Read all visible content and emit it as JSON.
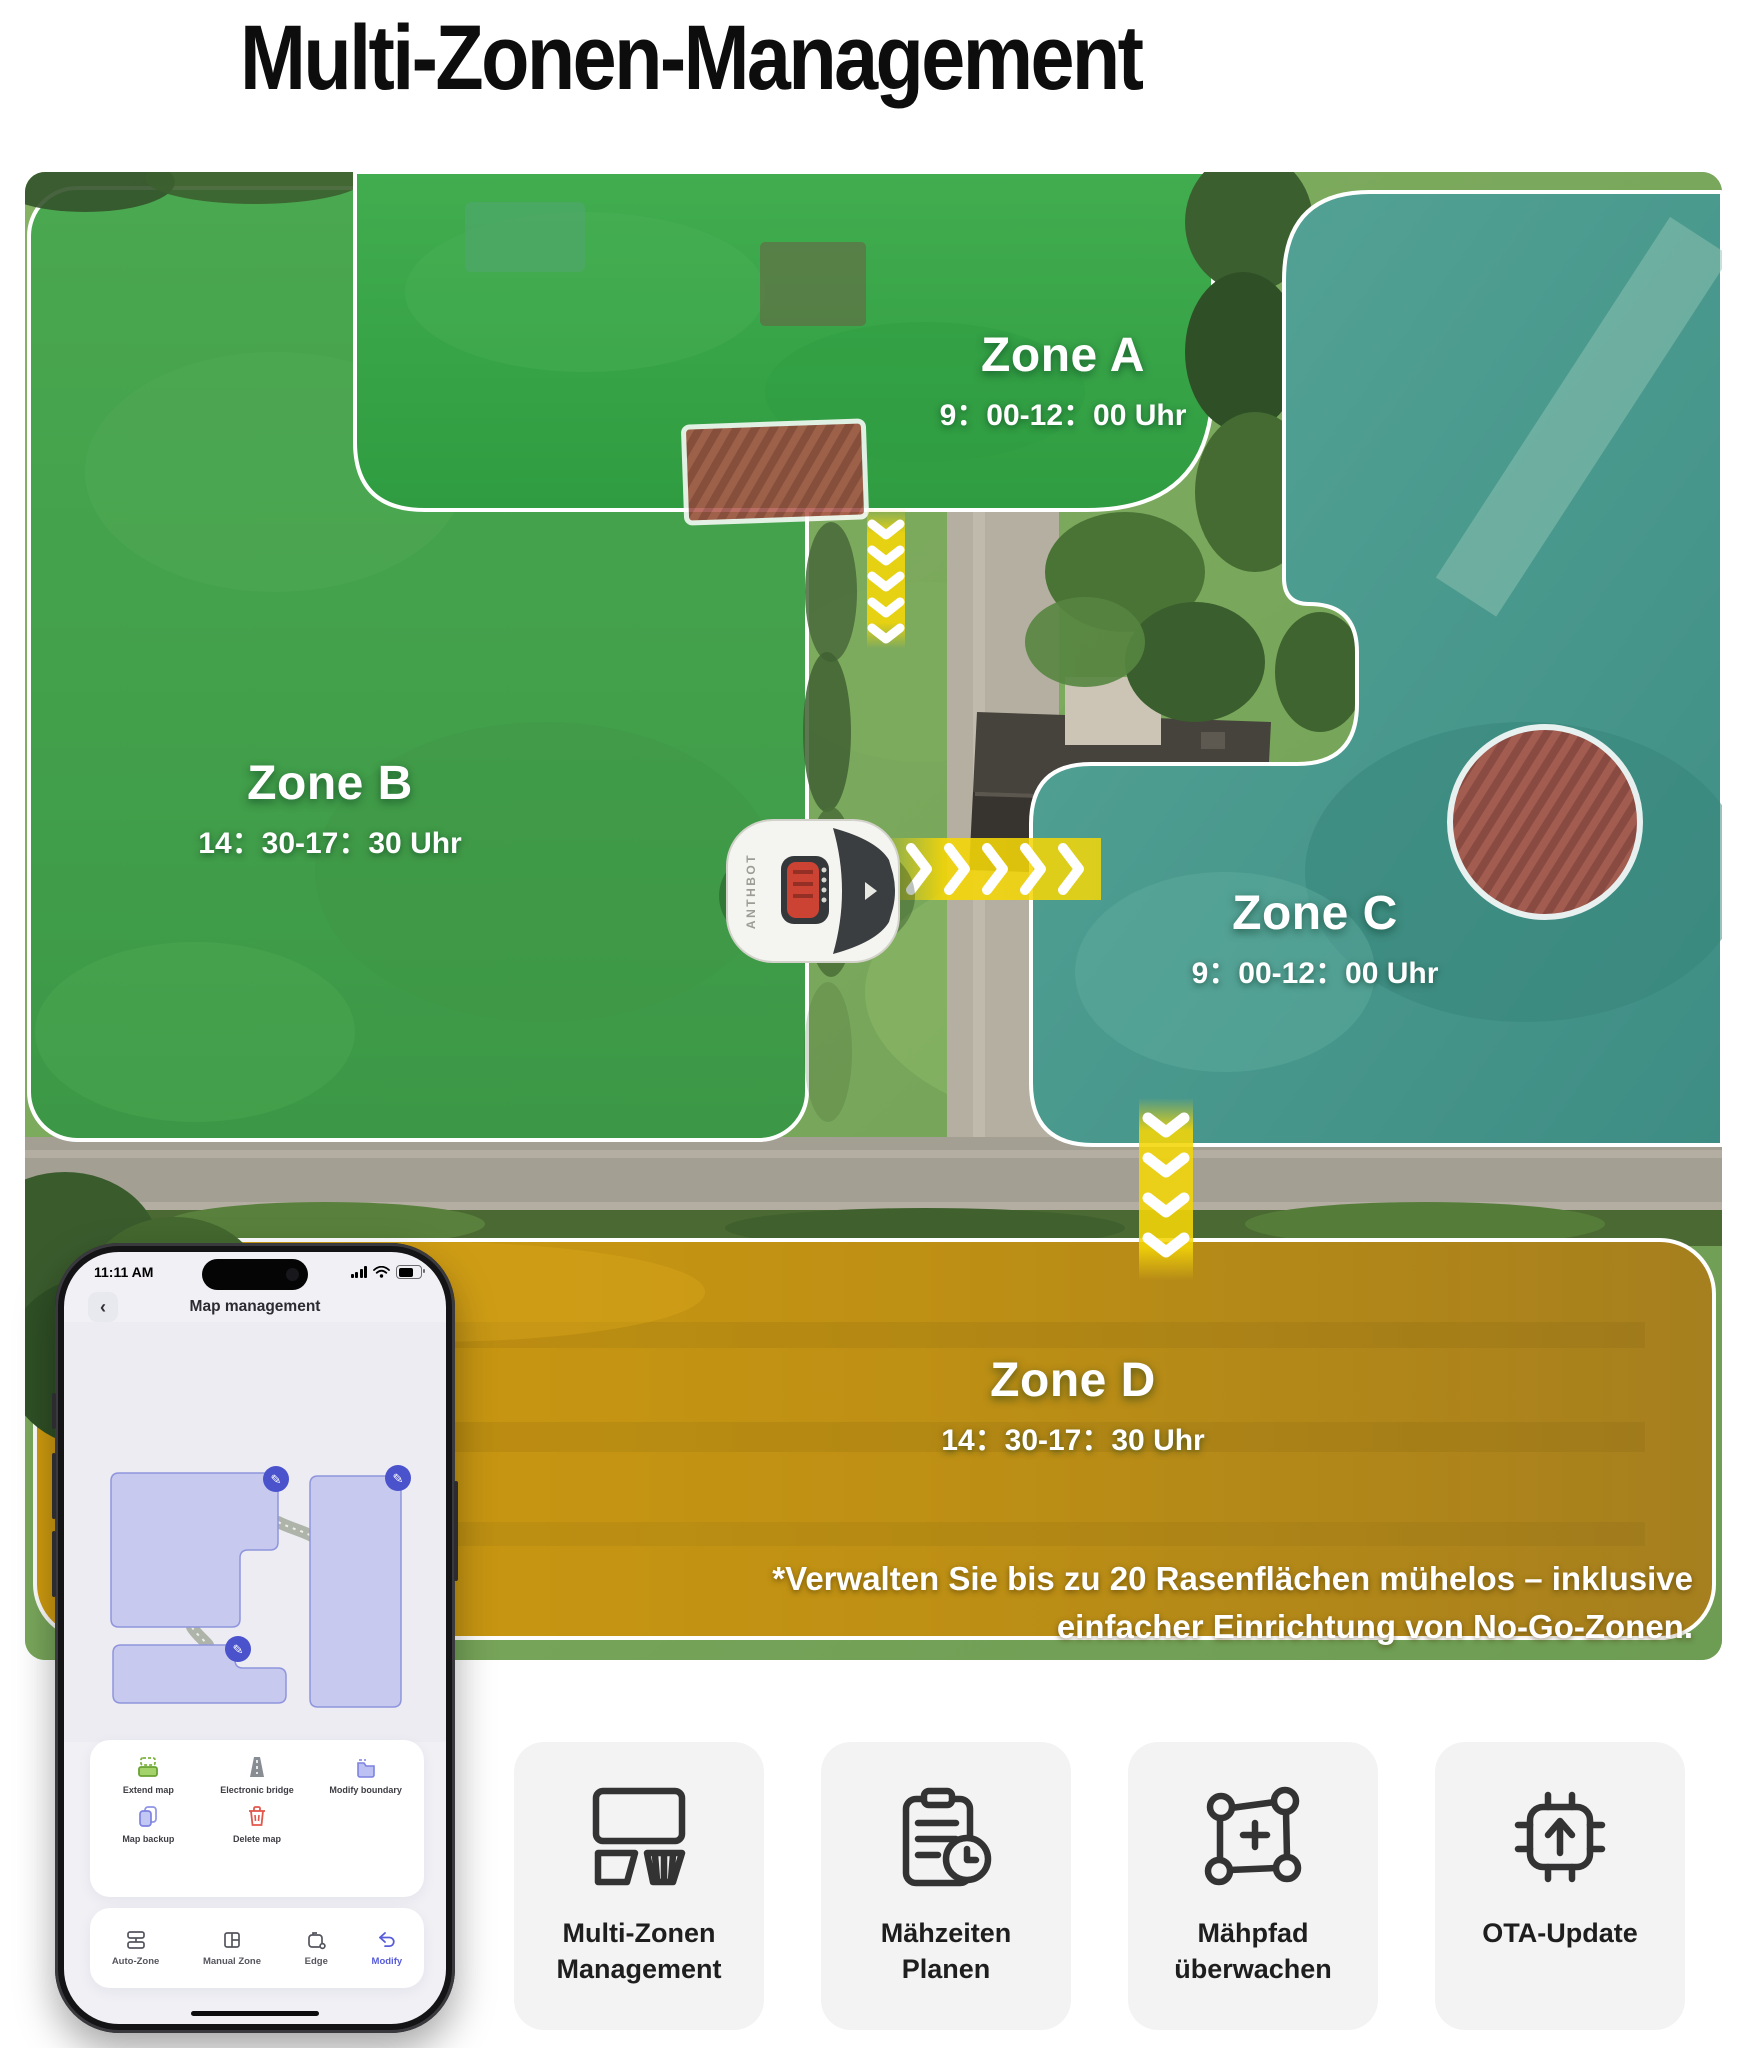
{
  "page": {
    "title": "Multi-Zonen-Management"
  },
  "map": {
    "zones": [
      {
        "id": "zone-a",
        "name": "Zone A",
        "time": "9：00-12：00 Uhr",
        "overlay_color": "#3aa44b"
      },
      {
        "id": "zone-b",
        "name": "Zone B",
        "time": "14：30-17：30 Uhr",
        "overlay_color": "#45a04c"
      },
      {
        "id": "zone-c",
        "name": "Zone C",
        "time": "9：00-12：00 Uhr",
        "overlay_color": "#4d9d90"
      },
      {
        "id": "zone-d",
        "name": "Zone D",
        "time": "14：30-17：30 Uhr",
        "overlay_color": "#c39210"
      }
    ],
    "footnote_line1": "*Verwalten Sie bis zu 20 Rasenflächen mühelos – inklusive",
    "footnote_line2": "einfacher Einrichtung von No-Go-Zonen.",
    "mower_brand": "ANTHBOT",
    "no_go_color": "#b6453c",
    "arrow_color": "#f4d608"
  },
  "phone": {
    "status": {
      "time": "11:11 AM"
    },
    "header": {
      "back_icon": "‹",
      "title": "Map management"
    },
    "actions": [
      {
        "label": "Extend map"
      },
      {
        "label": "Electronic bridge"
      },
      {
        "label": "Modify boundary"
      },
      {
        "label": "Map backup"
      },
      {
        "label": "Delete map"
      }
    ],
    "tabs": [
      {
        "label": "Auto-Zone",
        "active": false
      },
      {
        "label": "Manual Zone",
        "active": false
      },
      {
        "label": "Edge",
        "active": false
      },
      {
        "label": "Modify",
        "active": true
      }
    ],
    "accent_color": "#575cd8",
    "zone_fill": "#c7c9ee"
  },
  "features": [
    {
      "icon": "multi-zone-icon",
      "label_line1": "Multi-Zonen",
      "label_line2": "Management"
    },
    {
      "icon": "schedule-icon",
      "label_line1": "Mähzeiten",
      "label_line2": "Planen"
    },
    {
      "icon": "path-monitor-icon",
      "label_line1": "Mähpfad",
      "label_line2": "überwachen"
    },
    {
      "icon": "ota-update-icon",
      "label_line1": "OTA-Update",
      "label_line2": ""
    }
  ]
}
